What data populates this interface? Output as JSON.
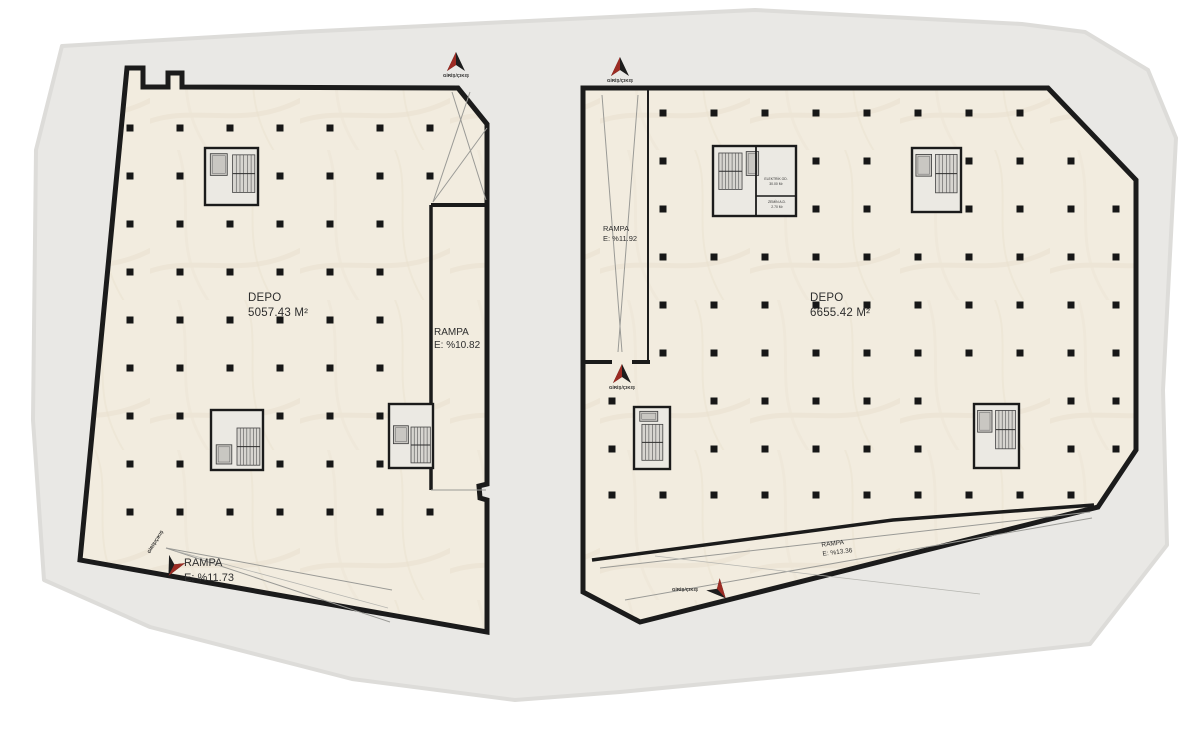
{
  "plan": {
    "title": "Depo kat planı",
    "entrance_label": "GİRİŞ/ÇIKIŞ",
    "buildings": [
      {
        "id": "left",
        "depo": {
          "label": "DEPO",
          "area": "5057.43 M²"
        },
        "ramps": [
          {
            "label": "RAMPA",
            "slope": "E: %11.73"
          },
          {
            "label": "RAMPA",
            "slope": "E: %10.82"
          }
        ]
      },
      {
        "id": "right",
        "depo": {
          "label": "DEPO",
          "area": "6655.42 M²"
        },
        "ramps": [
          {
            "label": "RAMPA",
            "slope": "E: %11.92"
          },
          {
            "label": "RAMPA",
            "slope": "E: %13.36"
          }
        ],
        "rooms": [
          {
            "label": "ELEKTRİK OD.",
            "area": "30.00 M²"
          },
          {
            "label": "ZEMİN A.D.",
            "area": "2.70 M²"
          }
        ]
      }
    ],
    "colors": {
      "plot": "#e9e8e5",
      "plot_edge": "#dddcd9",
      "floor": "#f2ecdf",
      "wall": "#1b1b1b",
      "thin_line": "#9a9a96",
      "column": "#171717",
      "core_fill": "#ebe9e3",
      "arrow_red": "#9c2b23",
      "arrow_dark": "#1d1d1d"
    }
  }
}
